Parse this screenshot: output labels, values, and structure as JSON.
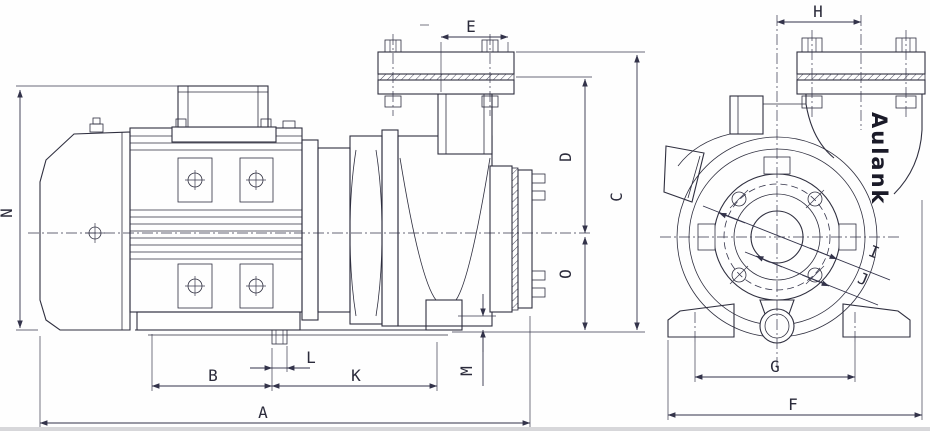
{
  "drawing": {
    "brand": "Aulank",
    "dimension_labels": {
      "a": "A",
      "b": "B",
      "c": "C",
      "d": "D",
      "e": "E",
      "f": "F",
      "g": "G",
      "h": "H",
      "i": "I",
      "j": "J",
      "k": "K",
      "l": "L",
      "m": "M",
      "n": "N",
      "o": "O"
    }
  }
}
